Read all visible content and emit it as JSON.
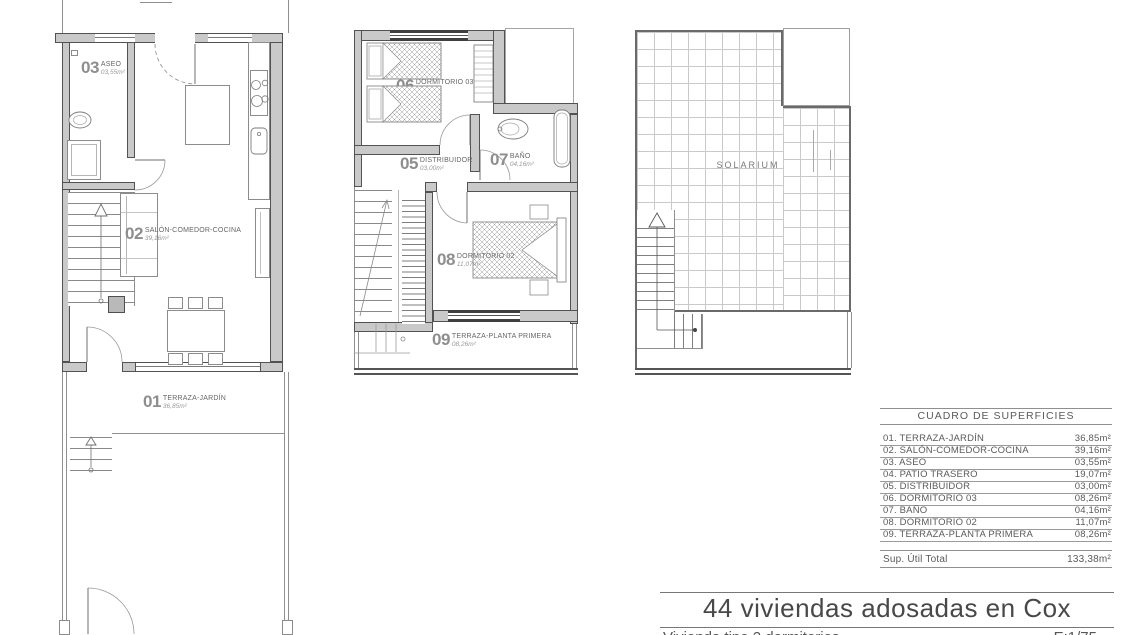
{
  "ground_floor": {
    "label_03": {
      "num": "03",
      "name": "ASEO",
      "area": "03,55m²"
    },
    "label_02": {
      "num": "02",
      "name": "SALÓN-COMEDOR-COCINA",
      "area": "39,16m²"
    },
    "label_01": {
      "num": "01",
      "name": "TERRAZA-JARDÍN",
      "area": "36,85m²"
    }
  },
  "first_floor": {
    "label_06": {
      "num": "06",
      "name": "DORMITORIO 03",
      "area": "08,26m²"
    },
    "label_05": {
      "num": "05",
      "name": "DISTRIBUIDOR",
      "area": "03,00m²"
    },
    "label_07": {
      "num": "07",
      "name": "BAÑO",
      "area": "04,16m²"
    },
    "label_08": {
      "num": "08",
      "name": "DORMITORIO 02",
      "area": "11,07m²"
    },
    "label_09": {
      "num": "09",
      "name": "TERRAZA-PLANTA PRIMERA",
      "area": "08,26m²"
    }
  },
  "solarium_floor": {
    "label": "SOLARIUM"
  },
  "surfaces_table": {
    "title": "CUADRO DE SUPERFICIES",
    "rows": [
      {
        "label": "01. TERRAZA-JARDÍN",
        "value": "36,85m²"
      },
      {
        "label": "02. SALÓN-COMEDOR-COCINA",
        "value": "39,16m²"
      },
      {
        "label": "03. ASEO",
        "value": "03,55m²"
      },
      {
        "label": "04. PATIO TRASERO",
        "value": "19,07m²"
      },
      {
        "label": "05. DISTRIBUIDOR",
        "value": "03,00m²"
      },
      {
        "label": "06. DORMITORIO 03",
        "value": "08,26m²"
      },
      {
        "label": "07. BAÑO",
        "value": "04,16m²"
      },
      {
        "label": "08. DORMITORIO 02",
        "value": "11,07m²"
      },
      {
        "label": "09. TERRAZA-PLANTA PRIMERA",
        "value": "08,26m²"
      }
    ],
    "total": {
      "label": "Sup. Útil Total",
      "value": "133,38m²"
    }
  },
  "title_block": {
    "project": "44 viviendas adosadas en Cox",
    "subtitle": "Vivienda tipo 2 dormitorios",
    "scale": "E:1/75"
  }
}
